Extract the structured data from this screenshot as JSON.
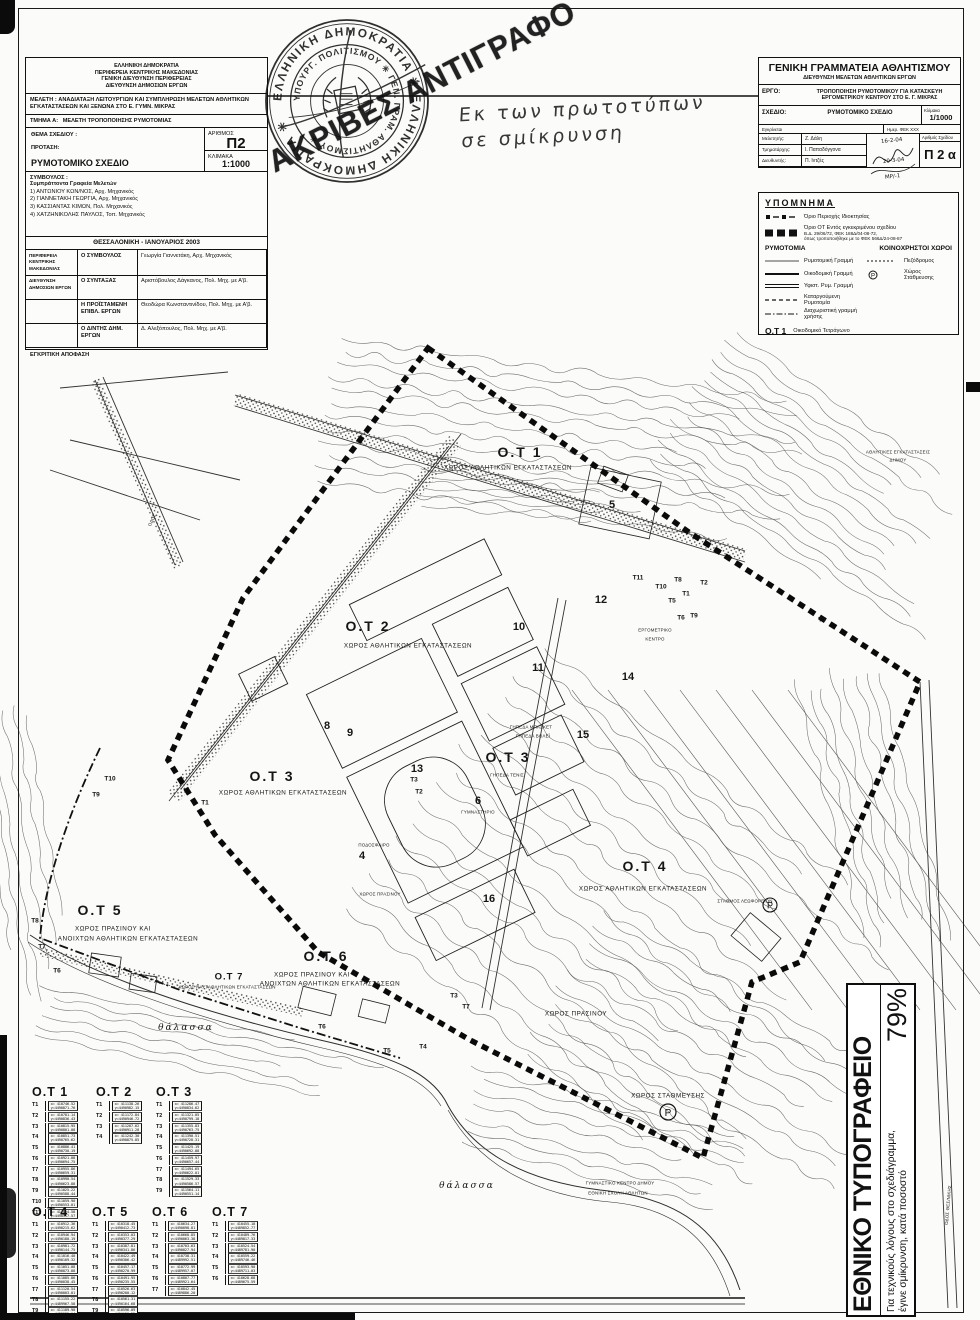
{
  "header_left": {
    "agency_lines": [
      "ΕΛΛΗΝΙΚΗ ΔΗΜΟΚΡΑΤΙΑ",
      "ΠΕΡΙΦΕΡΕΙΑ ΚΕΝΤΡΙΚΗΣ ΜΑΚΕΔΟΝΙΑΣ",
      "ΓΕΝΙΚΗ ΔΙΕΥΘΥΝΣΗ ΠΕΡΙΦΕΡΕΙΑΣ",
      "ΔΙΕΥΘΥΝΣΗ ΔΗΜΟΣΙΩΝ ΕΡΓΩΝ"
    ],
    "study_label": "ΜΕΛΕΤΗ :",
    "study_text": "ΑΝΑΔΙΑΤΑΞΗ ΛΕΙΤΟΥΡΓΙΩΝ ΚΑΙ ΣΥΜΠΛΗΡΩΣΗ ΜΕΛΕΤΩΝ ΑΘΛΗΤΙΚΩΝ ΕΓΚΑΤΑΣΤΑΣΕΩΝ ΚΑΙ ΞΕΝΩΝΑ ΣΤΟ Ε. ΓΥΜΝ. ΜΙΚΡΑΣ",
    "section_label": "ΤΜΗΜΑ Α:",
    "section_text": "ΜΕΛΕΤΗ ΤΡΟΠΟΠΟΙΗΣΗΣ ΡΥΜΟΤΟΜΙΑΣ",
    "subject_label": "ΘΕΜΑ ΣΧΕΔΙΟΥ :",
    "proposal_label": "ΠΡΟΤΑΣΗ:",
    "drawing_title": "ΡΥΜΟΤΟΜΙΚΟ ΣΧΕΔΙΟ",
    "number_label": "ΑΡΙΘΜΟΣ",
    "number": "Π2",
    "scale_label": "ΚΛΙΜΑΚΑ",
    "scale": "1:1000",
    "consultant_label": "ΣΥΜΒΟΥΛΟΣ :",
    "consultant_sub": "Συμπράττοντα Γραφεία Μελετών",
    "consultants": [
      "1) ΑΝΤΩΝΙΟΥ ΚΩΝ/ΝΟΣ, Αρχ. Μηχανικός",
      "2) ΓΙΑΝΝΕΤΑΚΗ ΓΕΩΡΓΙΑ, Αρχ. Μηχανικός",
      "3) ΚΑΣΣΙΑΝΤΑΣ ΚΙΜΩΝ, Πολ. Μηχανικός",
      "4) ΧΑΤΖΗΝΙΚΟΛΗΣ ΠΑΥΛΟΣ, Τοπ. Μηχανικός"
    ],
    "place_date": "ΘΕΣΣΑΛΟΝΙΚΗ  -  ΙΑΝΟΥΑΡΙΟΣ 2003",
    "sign_rows": [
      {
        "group": "ΠΕΡΙΦΕΡΕΙΑ ΚΕΝΤΡΙΚΗΣ ΜΑΚΕΔΟΝΙΑΣ",
        "role": "Ο ΣΥΜΒΟΥΛΟΣ",
        "name": "Γεωργία Γιαννετάκη, Αρχ. Μηχανικός"
      },
      {
        "group": "ΔΙΕΥΘΥΝΣΗ ΔΗΜΟΣΙΩΝ ΕΡΓΩΝ",
        "role": "Ο ΣΥΝΤΑΞΑΣ",
        "name": "Αριστόβουλος Δάγκανος, Πολ. Μηχ. με Α'β."
      },
      {
        "group": "",
        "role": "Η ΠΡΟΪΣΤΑΜΕΝΗ ΕΠΙΒΛ. ΕΡΓΩΝ",
        "name": "Θεοδώρα Κωνσταντινίδου, Πολ. Μηχ. με Α'β."
      },
      {
        "group": "",
        "role": "Ο Δ/ΝΤΗΣ ΔΗΜ. ΕΡΓΩΝ",
        "name": "Δ. Αλεξόπουλος, Πολ. Μηχ. με Α'β."
      }
    ],
    "footer": "ΕΓΚΡΙΤΙΚΗ ΑΠΟΦΑΣΗ"
  },
  "stamp": {
    "outer_ring": "ΕΛΛΗΝΙΚΗ ΔΗΜΟΚΡΑΤΙΑ ✳ ΕΛΛΗΝΙΚΗ ΔΗΜΟΚΡΑΤΙΑ ✳",
    "inner_ring": "ΥΠΟΥΡΓ. ΠΟΛΙΤΙΣΜΟΥ ✳ ΓΕΝ. ΓΡΑΜ. ΑΘΛΗΤΙΣΜΟΥ ✳",
    "overprint": "ΑΚΡΙΒΕΣ ΑΝΤΙΓΡΑΦΟ"
  },
  "handwriting": {
    "line1": "Εκ των πρωτοτύπων",
    "line2": "σε σμίκρυνση"
  },
  "header_right": {
    "h1": "ΓΕΝΙΚΗ ΓΡΑΜΜΑΤΕΙΑ ΑΘΛΗΤΙΣΜΟΥ",
    "h2": "ΔΙΕΥΘΥΝΣΗ ΜΕΛΕΤΩΝ ΑΘΛΗΤΙΚΩΝ ΕΡΓΩΝ",
    "ergo_label": "ΕΡΓΟ:",
    "ergo_text": "ΤΡΟΠΟΠΟΙΗΣΗ ΡΥΜΟΤΟΜΙΚΟΥ ΓΙΑ ΚΑΤΑΣΚΕΥΗ ΕΡΓΟΜΕΤΡΙΚΟΥ ΚΕΝΤΡΟΥ ΣΤΟ Ε. Γ. ΜΙΚΡΑΣ",
    "sxedio_label": "ΣΧΕΔΙΟ:",
    "sxedio_text": "ΡΥΜΟΤΟΜΙΚΟ ΣΧΕΔΙΟ",
    "scale_label": "Κλίμακα",
    "scale": "1/1000",
    "mini_left": "Εγκρίνεται",
    "mini_right": "Ημερ. ΦΕΚ ΧΧΧ",
    "staff": [
      {
        "k": "Μελετητής:",
        "v": "Ζ. Δάλη"
      },
      {
        "k": "Τμηματάρχης:",
        "v": "Ι. Παπαδόγγονα"
      },
      {
        "k": "Διευθυντής:",
        "v": "Π. Ιντζές"
      }
    ],
    "dates": [
      "16-2-04",
      "20-3-04",
      "ΜΡ/-1"
    ],
    "sheet_no_label": "Αριθμός Σχεδίου",
    "sheet_no": "Π 2 α"
  },
  "legend": {
    "title": "ΥΠΟΜΝΗΜΑ",
    "top_rows": [
      {
        "sym": "sqdashdot",
        "label": "Όριο Περιοχής Ιδιοκτησίας",
        "sub": []
      },
      {
        "sym": "boldsq",
        "label": "Όριο ΟΤ Εντός εγκεκριμένου σχεδίου",
        "sub": [
          "Β.Δ. 29/06/72, ΦΕΚ 188Δ/04-08-72,",
          "όπως τροποποιήθηκε με το ΦΕΚ 566Δ/24-08-87"
        ]
      }
    ],
    "col1_head": "ΡΥΜΟΤΟΜΙΑ",
    "col2_head": "ΚΟΙΝΟΧΡΗΣΤΟΙ ΧΩΡΟΙ",
    "rymotomia": [
      {
        "sym": "thin",
        "label": "Ρυμοτομική Γραμμή"
      },
      {
        "sym": "solid",
        "label": "Οικοδομική Γραμμή"
      },
      {
        "sym": "double",
        "label": "Υφιστ. Ρυμ. Γραμμή"
      },
      {
        "sym": "dashed",
        "label": "Καταργούμενη Ρυμοτομία"
      },
      {
        "sym": "dashdot",
        "label": "Διαχωριστική γραμμή χρήσης"
      }
    ],
    "koinoxrista": [
      {
        "sym": "ped",
        "label": "Πεζόδρομος"
      },
      {
        "sym": "park",
        "label": "Χώρος Στάθμευσης"
      }
    ],
    "ot_key": "Ο.Τ 1",
    "ot_key_label": "Οικοδομικό Τετράγωνο"
  },
  "map": {
    "labels": [
      {
        "x": 520,
        "y": 452,
        "t": "Ο.Τ 1",
        "c": "xl"
      },
      {
        "x": 508,
        "y": 468,
        "t": "ΧΩΡΟΣ ΑΘΛΗΤΙΚΩΝ ΕΓΚΑΤΑΣΤΑΣΕΩΝ",
        "c": "sm"
      },
      {
        "x": 368,
        "y": 626,
        "t": "Ο.Τ 2",
        "c": "xl"
      },
      {
        "x": 408,
        "y": 646,
        "t": "ΧΩΡΟΣ ΑΘΛΗΤΙΚΩΝ ΕΓΚΑΤΑΣΤΑΣΕΩΝ",
        "c": "sm"
      },
      {
        "x": 272,
        "y": 776,
        "t": "Ο.Τ 3",
        "c": "xl"
      },
      {
        "x": 283,
        "y": 793,
        "t": "ΧΩΡΟΣ ΑΘΛΗΤΙΚΩΝ ΕΓΚΑΤΑΣΤΑΣΕΩΝ",
        "c": "sm"
      },
      {
        "x": 508,
        "y": 757,
        "t": "Ο.Τ 3",
        "c": "xl"
      },
      {
        "x": 507,
        "y": 775,
        "t": "ΓΗΠΕΔΑ ΤΕΝΙΣ",
        "c": "xs"
      },
      {
        "x": 645,
        "y": 866,
        "t": "Ο.Τ 4",
        "c": "xl"
      },
      {
        "x": 643,
        "y": 889,
        "t": "ΧΩΡΟΣ ΑΘΛΗΤΙΚΩΝ ΕΓΚΑΤΑΣΤΑΣΕΩΝ",
        "c": "sm"
      },
      {
        "x": 100,
        "y": 910,
        "t": "Ο.Τ 5",
        "c": "xl"
      },
      {
        "x": 113,
        "y": 929,
        "t": "ΧΩΡΟΣ ΠΡΑΣΙΝΟΥ ΚΑΙ",
        "c": "sm"
      },
      {
        "x": 128,
        "y": 939,
        "t": "ΑΝΟΙΧΤΩΝ ΑΘΛΗΤΙΚΩΝ ΕΓΚΑΤΑΣΤΑΣΕΩΝ",
        "c": "sm"
      },
      {
        "x": 326,
        "y": 956,
        "t": "Ο.Τ 6",
        "c": "xl"
      },
      {
        "x": 312,
        "y": 975,
        "t": "ΧΩΡΟΣ ΠΡΑΣΙΝΟΥ ΚΑΙ",
        "c": "sm"
      },
      {
        "x": 330,
        "y": 984,
        "t": "ΑΝΟΙΧΤΩΝ ΑΘΛΗΤΙΚΩΝ ΕΓΚΑΤΑΣΤΑΣΕΩΝ",
        "c": "sm"
      },
      {
        "x": 229,
        "y": 977,
        "t": "Ο.Τ 7",
        "c": "md"
      },
      {
        "x": 227,
        "y": 987,
        "t": "ΧΩΡΟΣ ΝΑΥΤΑΘΛΗΤΙΚΩΝ ΕΓΚΑΤΑΣΤΑΣΕΩΝ",
        "c": "xs"
      },
      {
        "x": 576,
        "y": 1014,
        "t": "ΧΩΡΟΣ ΠΡΑΣΙΝΟΥ",
        "c": "sm"
      },
      {
        "x": 380,
        "y": 894,
        "t": "ΧΩΡΟΣ ΠΡΑΣΙΝΟΥ",
        "c": "xs"
      },
      {
        "x": 668,
        "y": 1096,
        "t": "ΧΩΡΟΣ ΣΤΑΘΜΕΥΣΗΣ",
        "c": "sm"
      },
      {
        "x": 186,
        "y": 1028,
        "t": "θάλασσα",
        "c": "it"
      },
      {
        "x": 467,
        "y": 1186,
        "t": "θάλασσα",
        "c": "it"
      },
      {
        "x": 655,
        "y": 630,
        "t": "ΕΡΓΟΜΕΤΡΙΚΟ",
        "c": "xs"
      },
      {
        "x": 655,
        "y": 639,
        "t": "ΚΕΝΤΡΟ",
        "c": "xs"
      },
      {
        "x": 531,
        "y": 727,
        "t": "ΓΗΠΕΔΑ ΜΠΑΣΚΕΤ",
        "c": "xs"
      },
      {
        "x": 533,
        "y": 736,
        "t": "ΓΗΠΕΔΑ ΒΟΛΕΪ",
        "c": "xs"
      },
      {
        "x": 478,
        "y": 812,
        "t": "ΓΥΜΝΑΣΤΗΡΙΟ",
        "c": "xs"
      },
      {
        "x": 374,
        "y": 845,
        "t": "ΠΟΔΟΣΦΑΙΡΟ",
        "c": "xs"
      },
      {
        "x": 620,
        "y": 1183,
        "t": "ΓΥΜΝΑΣΤΙΚΟ ΚΕΝΤΡΟ ΔΗΜΟΥ",
        "c": "xs"
      },
      {
        "x": 618,
        "y": 1193,
        "t": "ΕΘΝΙΚΗ ΣΧΟΛΗ ΑΘΛΗΤΩΝ",
        "c": "xs"
      },
      {
        "x": 898,
        "y": 452,
        "t": "ΑΘΛΗΤΙΚΕΣ ΕΓΚΑΤΑΣΤΑΣΕΙΣ",
        "c": "xs"
      },
      {
        "x": 898,
        "y": 460,
        "t": "ΔΗΜΟΥ",
        "c": "xs"
      },
      {
        "x": 745,
        "y": 901,
        "t": "ΣΤΑΘΜΟΣ ΛΕΩΦΟΡΕΙΩΝ",
        "c": "xs"
      },
      {
        "x": 152,
        "y": 520,
        "t": "ΟΔΟΣ",
        "c": "xs",
        "r": -65
      },
      {
        "x": 948,
        "y": 1205,
        "t": "ΟΔΟΣ ΘΕΣ/ΝΙΚΗΣ",
        "c": "xs",
        "r": -85
      },
      {
        "x": 362,
        "y": 856,
        "t": "4",
        "c": "num"
      },
      {
        "x": 612,
        "y": 505,
        "t": "5",
        "c": "num"
      },
      {
        "x": 478,
        "y": 801,
        "t": "6",
        "c": "num"
      },
      {
        "x": 327,
        "y": 726,
        "t": "8",
        "c": "num"
      },
      {
        "x": 350,
        "y": 733,
        "t": "9",
        "c": "num"
      },
      {
        "x": 519,
        "y": 627,
        "t": "10",
        "c": "num"
      },
      {
        "x": 538,
        "y": 668,
        "t": "11",
        "c": "num"
      },
      {
        "x": 601,
        "y": 600,
        "t": "12",
        "c": "num"
      },
      {
        "x": 417,
        "y": 769,
        "t": "13",
        "c": "num"
      },
      {
        "x": 628,
        "y": 677,
        "t": "14",
        "c": "num"
      },
      {
        "x": 583,
        "y": 735,
        "t": "15",
        "c": "num"
      },
      {
        "x": 489,
        "y": 899,
        "t": "16",
        "c": "num"
      },
      {
        "x": 638,
        "y": 578,
        "t": "T11",
        "c": "vtx"
      },
      {
        "x": 661,
        "y": 587,
        "t": "T10",
        "c": "vtx"
      },
      {
        "x": 678,
        "y": 580,
        "t": "T8",
        "c": "vtx"
      },
      {
        "x": 704,
        "y": 583,
        "t": "T2",
        "c": "vtx"
      },
      {
        "x": 686,
        "y": 594,
        "t": "T1",
        "c": "vtx"
      },
      {
        "x": 672,
        "y": 601,
        "t": "T5",
        "c": "vtx"
      },
      {
        "x": 681,
        "y": 618,
        "t": "T6",
        "c": "vtx"
      },
      {
        "x": 694,
        "y": 616,
        "t": "T9",
        "c": "vtx"
      },
      {
        "x": 822,
        "y": 620,
        "t": "T4",
        "c": "vtx"
      },
      {
        "x": 454,
        "y": 996,
        "t": "T3",
        "c": "vtx"
      },
      {
        "x": 466,
        "y": 1007,
        "t": "T7",
        "c": "vtx"
      },
      {
        "x": 423,
        "y": 1047,
        "t": "T4",
        "c": "vtx"
      },
      {
        "x": 387,
        "y": 1051,
        "t": "T5",
        "c": "vtx"
      },
      {
        "x": 322,
        "y": 1027,
        "t": "T6",
        "c": "vtx"
      },
      {
        "x": 57,
        "y": 971,
        "t": "T6",
        "c": "vtx"
      },
      {
        "x": 42,
        "y": 947,
        "t": "T7",
        "c": "vtx"
      },
      {
        "x": 35,
        "y": 921,
        "t": "T8",
        "c": "vtx"
      },
      {
        "x": 96,
        "y": 795,
        "t": "T9",
        "c": "vtx"
      },
      {
        "x": 110,
        "y": 779,
        "t": "T10",
        "c": "vtx"
      },
      {
        "x": 205,
        "y": 803,
        "t": "T1",
        "c": "vtx"
      },
      {
        "x": 419,
        "y": 792,
        "t": "T2",
        "c": "vtx"
      },
      {
        "x": 414,
        "y": 780,
        "t": "T3",
        "c": "vtx"
      }
    ]
  },
  "tables": [
    {
      "title": "Ο.Τ 1",
      "x": 32,
      "y": 1085,
      "rows": [
        {
          "t": "T1",
          "x": "410746.52",
          "y": "4490871.76"
        },
        {
          "t": "T2",
          "x": "410781.14",
          "y": "4490836.43"
        },
        {
          "t": "T3",
          "x": "410815.95",
          "y": "4490801.08"
        },
        {
          "t": "T4",
          "x": "410851.73",
          "y": "4490765.62"
        },
        {
          "t": "T5",
          "x": "410886.41",
          "y": "4490730.19"
        },
        {
          "t": "T6",
          "x": "410921.08",
          "y": "4490694.75"
        },
        {
          "t": "T7",
          "x": "410955.86",
          "y": "4490659.31"
        },
        {
          "t": "T8",
          "x": "410990.54",
          "y": "4490623.88"
        },
        {
          "t": "T9",
          "x": "411025.22",
          "y": "4490588.44"
        },
        {
          "t": "T10",
          "x": "411059.90",
          "y": "4490553.01"
        },
        {
          "t": "T11",
          "x": "411094.58",
          "y": "4490517.57"
        }
      ]
    },
    {
      "title": "Ο.Τ 2",
      "x": 96,
      "y": 1085,
      "rows": [
        {
          "t": "T1",
          "x": "411138.26",
          "y": "4490982.15"
        },
        {
          "t": "T2",
          "x": "411172.84",
          "y": "4490946.72"
        },
        {
          "t": "T3",
          "x": "411207.62",
          "y": "4490911.28"
        },
        {
          "t": "T4",
          "x": "411242.30",
          "y": "4490875.85"
        }
      ]
    },
    {
      "title": "Ο.Τ 3",
      "x": 156,
      "y": 1085,
      "rows": [
        {
          "t": "T1",
          "x": "411286.47",
          "y": "4490834.62"
        },
        {
          "t": "T2",
          "x": "411321.05",
          "y": "4490799.18"
        },
        {
          "t": "T3",
          "x": "411355.83",
          "y": "4490763.75"
        },
        {
          "t": "T4",
          "x": "411390.51",
          "y": "4490728.31"
        },
        {
          "t": "T5",
          "x": "411425.19",
          "y": "4490692.88"
        },
        {
          "t": "T6",
          "x": "411459.97",
          "y": "4490657.44"
        },
        {
          "t": "T7",
          "x": "411494.65",
          "y": "4490622.01"
        },
        {
          "t": "T8",
          "x": "411529.33",
          "y": "4490586.57"
        },
        {
          "t": "T9",
          "x": "411564.11",
          "y": "4490551.14"
        }
      ]
    },
    {
      "title": "Ο.Τ 4",
      "x": 32,
      "y": 1205,
      "rows": [
        {
          "t": "T1",
          "x": "410912.36",
          "y": "4490215.62"
        },
        {
          "t": "T2",
          "x": "410946.94",
          "y": "4490180.19"
        },
        {
          "t": "T3",
          "x": "410981.72",
          "y": "4490144.75"
        },
        {
          "t": "T4",
          "x": "411016.40",
          "y": "4490109.32"
        },
        {
          "t": "T5",
          "x": "411051.08",
          "y": "4490073.88"
        },
        {
          "t": "T6",
          "x": "411085.86",
          "y": "4490038.45"
        },
        {
          "t": "T7",
          "x": "411120.54",
          "y": "4490003.01"
        },
        {
          "t": "T8",
          "x": "411155.22",
          "y": "4489967.58"
        },
        {
          "t": "T9",
          "x": "411189.90",
          "y": "4489932.14"
        }
      ]
    },
    {
      "title": "Ο.Τ 5",
      "x": 92,
      "y": 1205,
      "rows": [
        {
          "t": "T1",
          "x": "410318.45",
          "y": "4490412.73"
        },
        {
          "t": "T2",
          "x": "410353.03",
          "y": "4490377.29"
        },
        {
          "t": "T3",
          "x": "410387.81",
          "y": "4490341.86"
        },
        {
          "t": "T4",
          "x": "410422.49",
          "y": "4490306.42"
        },
        {
          "t": "T5",
          "x": "410457.17",
          "y": "4490270.99"
        },
        {
          "t": "T6",
          "x": "410491.95",
          "y": "4490235.55"
        },
        {
          "t": "T7",
          "x": "410526.63",
          "y": "4490200.12"
        },
        {
          "t": "T8",
          "x": "410561.31",
          "y": "4490164.68"
        },
        {
          "t": "T9",
          "x": "410596.09",
          "y": "4490129.25"
        }
      ]
    },
    {
      "title": "Ο.Τ 6",
      "x": 152,
      "y": 1205,
      "rows": [
        {
          "t": "T1",
          "x": "410634.27",
          "y": "4490098.81"
        },
        {
          "t": "T2",
          "x": "410668.85",
          "y": "4490063.38"
        },
        {
          "t": "T3",
          "x": "410703.63",
          "y": "4490027.94"
        },
        {
          "t": "T4",
          "x": "410738.31",
          "y": "4489992.51"
        },
        {
          "t": "T5",
          "x": "410772.99",
          "y": "4489957.07"
        },
        {
          "t": "T6",
          "x": "410807.77",
          "y": "4489921.64"
        },
        {
          "t": "T7",
          "x": "410842.45",
          "y": "4489886.20"
        }
      ]
    },
    {
      "title": "Ο.Τ 7",
      "x": 212,
      "y": 1205,
      "rows": [
        {
          "t": "T1",
          "x": "410455.18",
          "y": "4489852.77"
        },
        {
          "t": "T2",
          "x": "410489.76",
          "y": "4489817.33"
        },
        {
          "t": "T3",
          "x": "410524.54",
          "y": "4489781.90"
        },
        {
          "t": "T4",
          "x": "410559.22",
          "y": "4489746.46"
        },
        {
          "t": "T5",
          "x": "410593.90",
          "y": "4489711.03"
        },
        {
          "t": "T6",
          "x": "410628.68",
          "y": "4489675.59"
        }
      ]
    }
  ],
  "print_box": {
    "title": "ΕΘΝΙΚΟ ΤΥΠΟΓΡΑΦΕΙΟ",
    "note1": "Για τεχνικούς λόγους στο σχεδιάγραμμα,",
    "note2": "έγινε σμίκρυνση, κατά ποσοστό",
    "percent": "79%"
  }
}
